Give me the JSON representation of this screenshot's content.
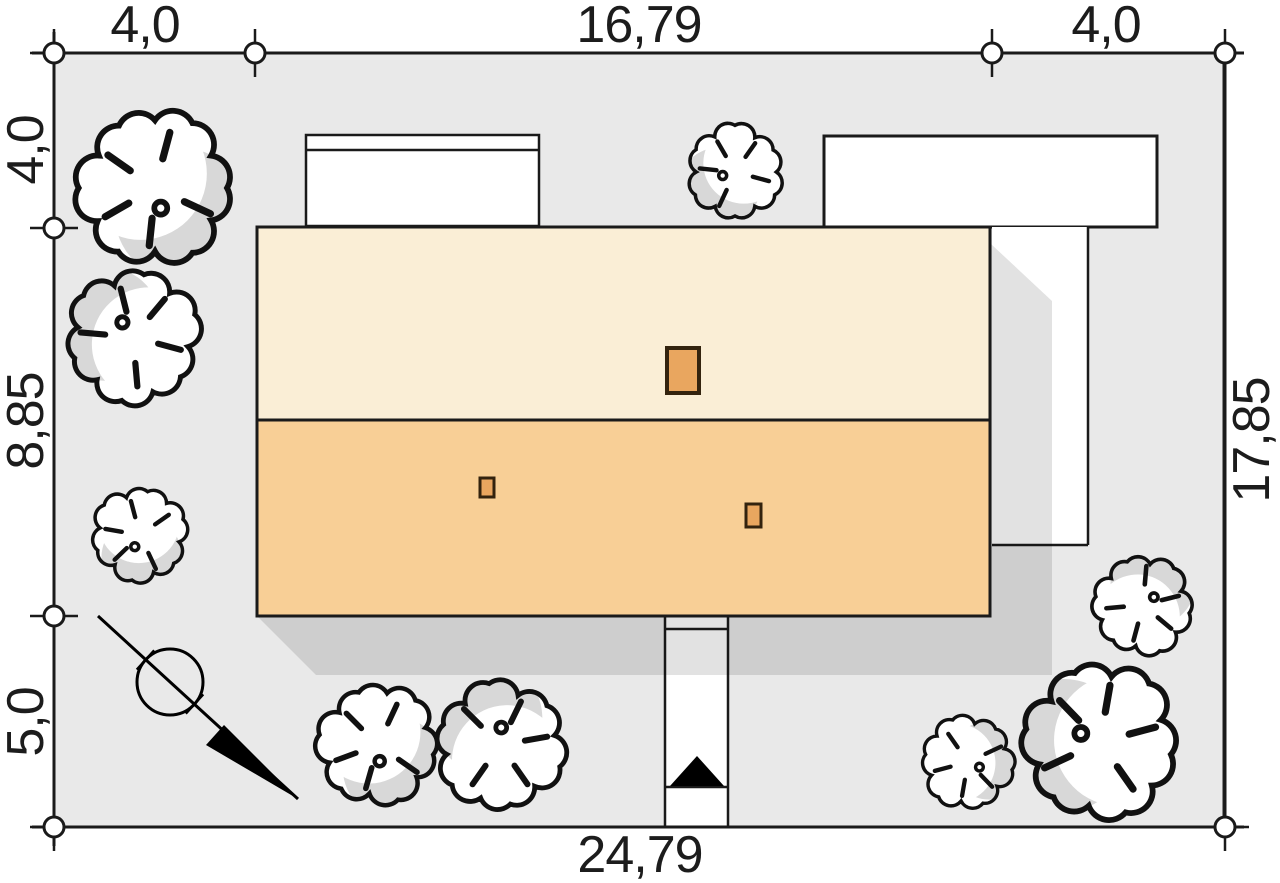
{
  "plan_title": "house site plan (roof view)",
  "dimensions": {
    "top": [
      "4,0",
      "16,79",
      "4,0"
    ],
    "left": [
      "4,0",
      "8,85",
      "5,0"
    ],
    "right": [
      "17,85"
    ],
    "bottom": [
      "24,79"
    ]
  },
  "colors": {
    "plot": "#e9e9e9",
    "roof_upper": "#faeed6",
    "roof_lower": "#f8cf96",
    "chimney": "#e9a65f",
    "chimney_border": "#33230e",
    "paving": "#ffffff",
    "outline": "#1a1a1a",
    "shadow": "rgba(0,0,0,0.115)",
    "tree_shade": "#d8d8d8"
  },
  "icons": {
    "north_arrow": "north-arrow",
    "entrance_arrow": "entrance-arrow",
    "tree": "tree"
  }
}
